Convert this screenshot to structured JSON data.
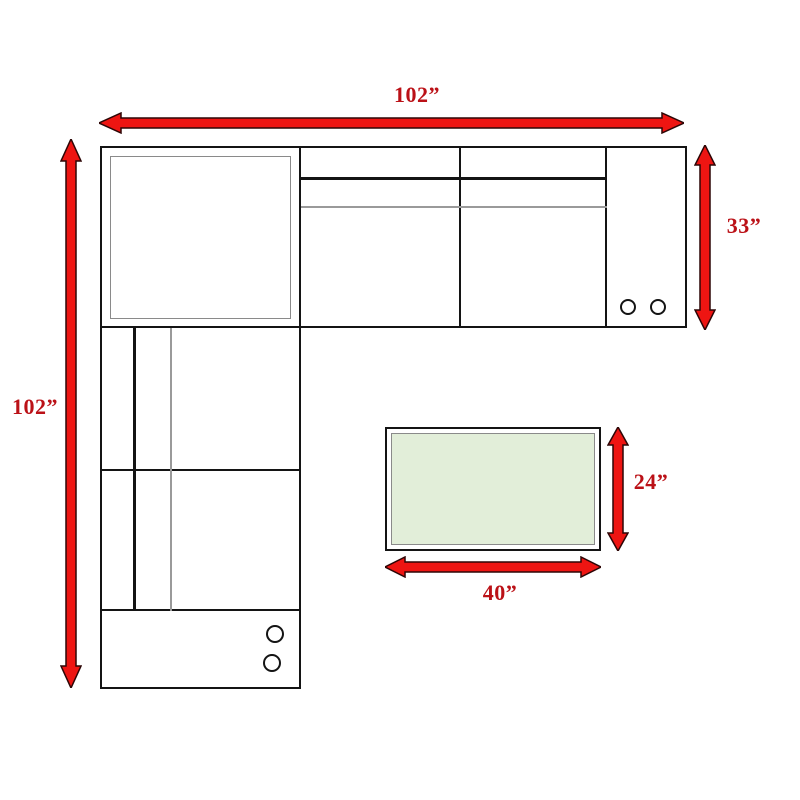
{
  "diagram": {
    "name": "sectional-sofa-dimension-plan",
    "labels": {
      "sectional_width": "102”",
      "sectional_depth": "102”",
      "sofa_depth": "33”",
      "ottoman_depth": "24”",
      "ottoman_width": "40”"
    },
    "colors": {
      "arrow_fill": "#ee1512",
      "arrow_stroke": "#2d0606",
      "label_text": "#bb1117",
      "outline": "#141414",
      "inner_line": "#8a8a8a",
      "ottoman_fill": "#e2eed9"
    }
  }
}
